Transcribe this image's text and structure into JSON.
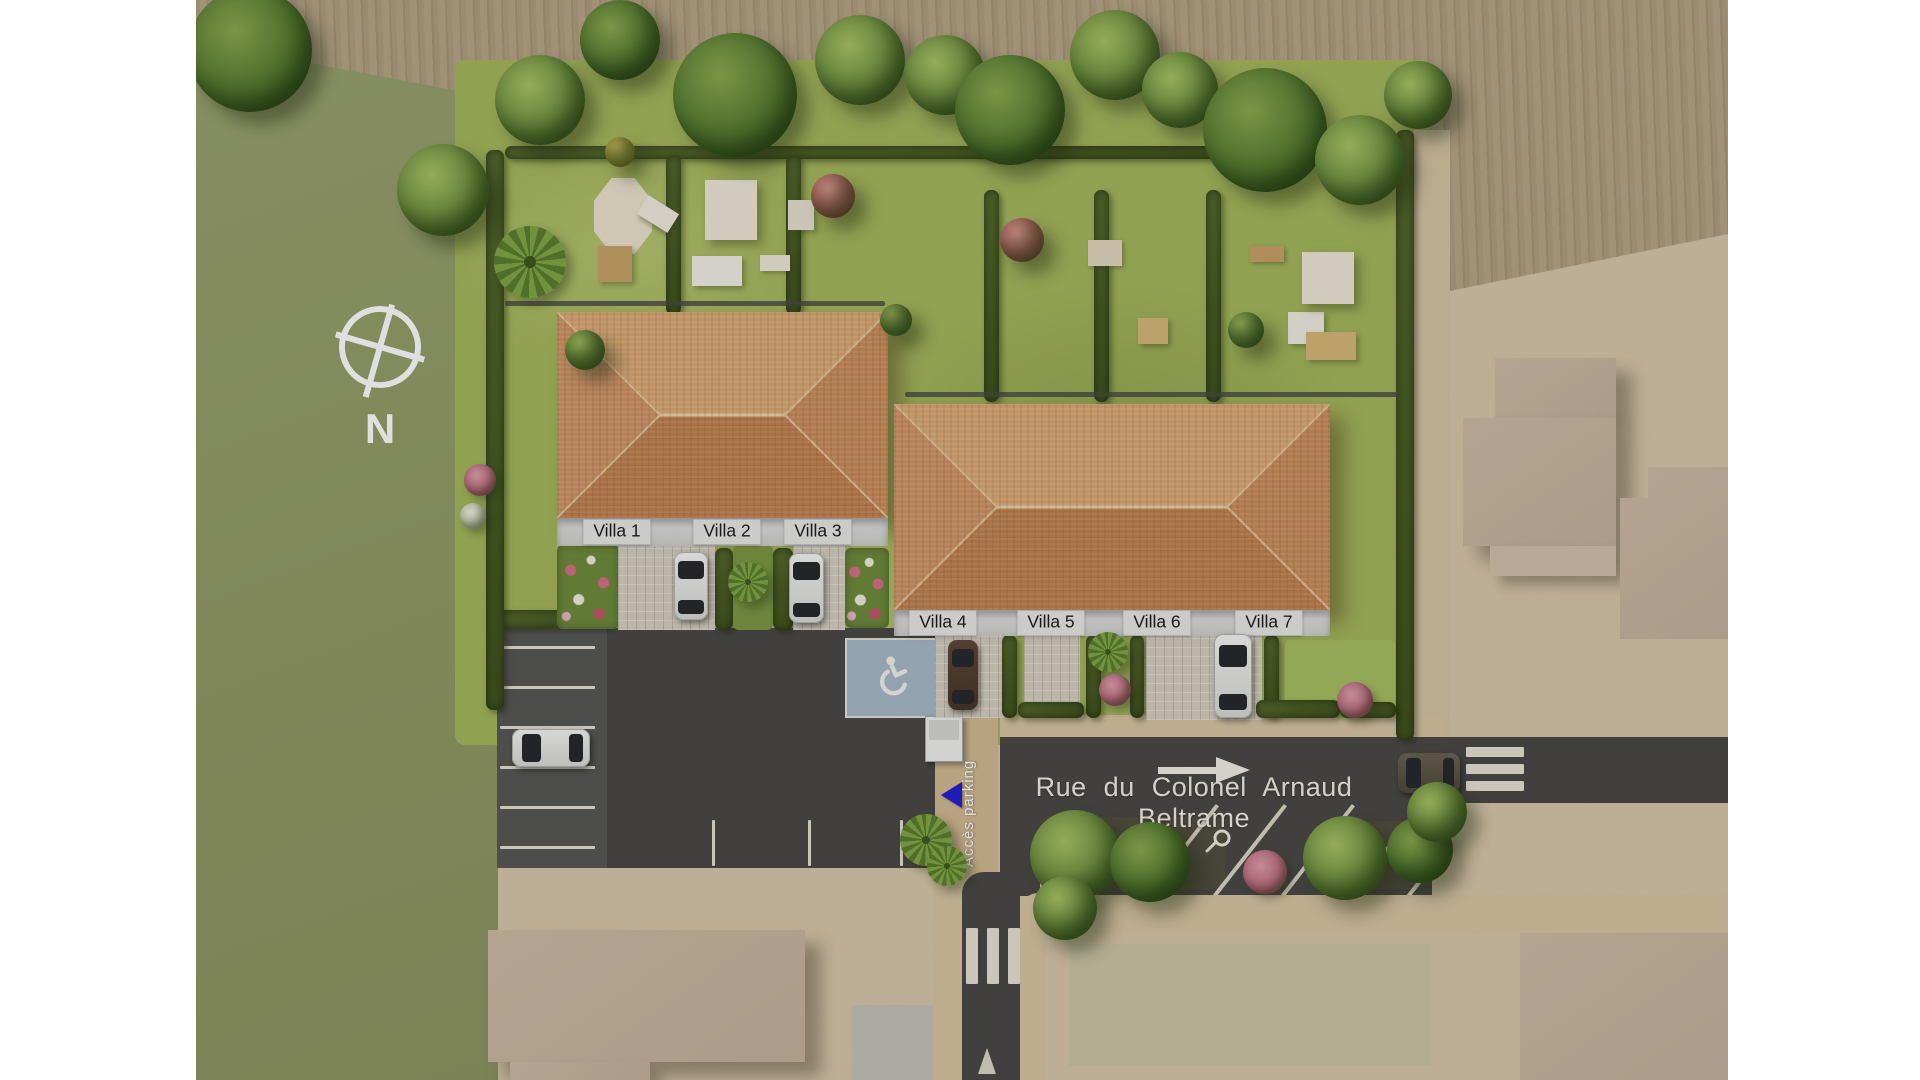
{
  "plan": {
    "villas": [
      "Villa 1",
      "Villa 2",
      "Villa 3",
      "Villa 4",
      "Villa 5",
      "Villa 6",
      "Villa 7"
    ],
    "street": {
      "name": "Rue du Colonel Arnaud Beltrame",
      "direction_arrow": "right"
    },
    "parking": {
      "access_label": "Accès parking",
      "entrance_marker_color": "#241fd0",
      "handicap_space": true
    },
    "compass": {
      "north_label": "N"
    }
  },
  "colors": {
    "roof_tile_light": "#dba873",
    "roof_tile_dark": "#c28350",
    "lawn_green": "#a6b85e",
    "field_olive": "#97a06c",
    "plowed_tan": "#b1a083",
    "asphalt": "#4c4a47",
    "sand": "#d9c8ab",
    "hedge_green": "#4c6026",
    "accent_blue": "#241fd0",
    "handicap_blue_gray": "#a9bac8"
  }
}
